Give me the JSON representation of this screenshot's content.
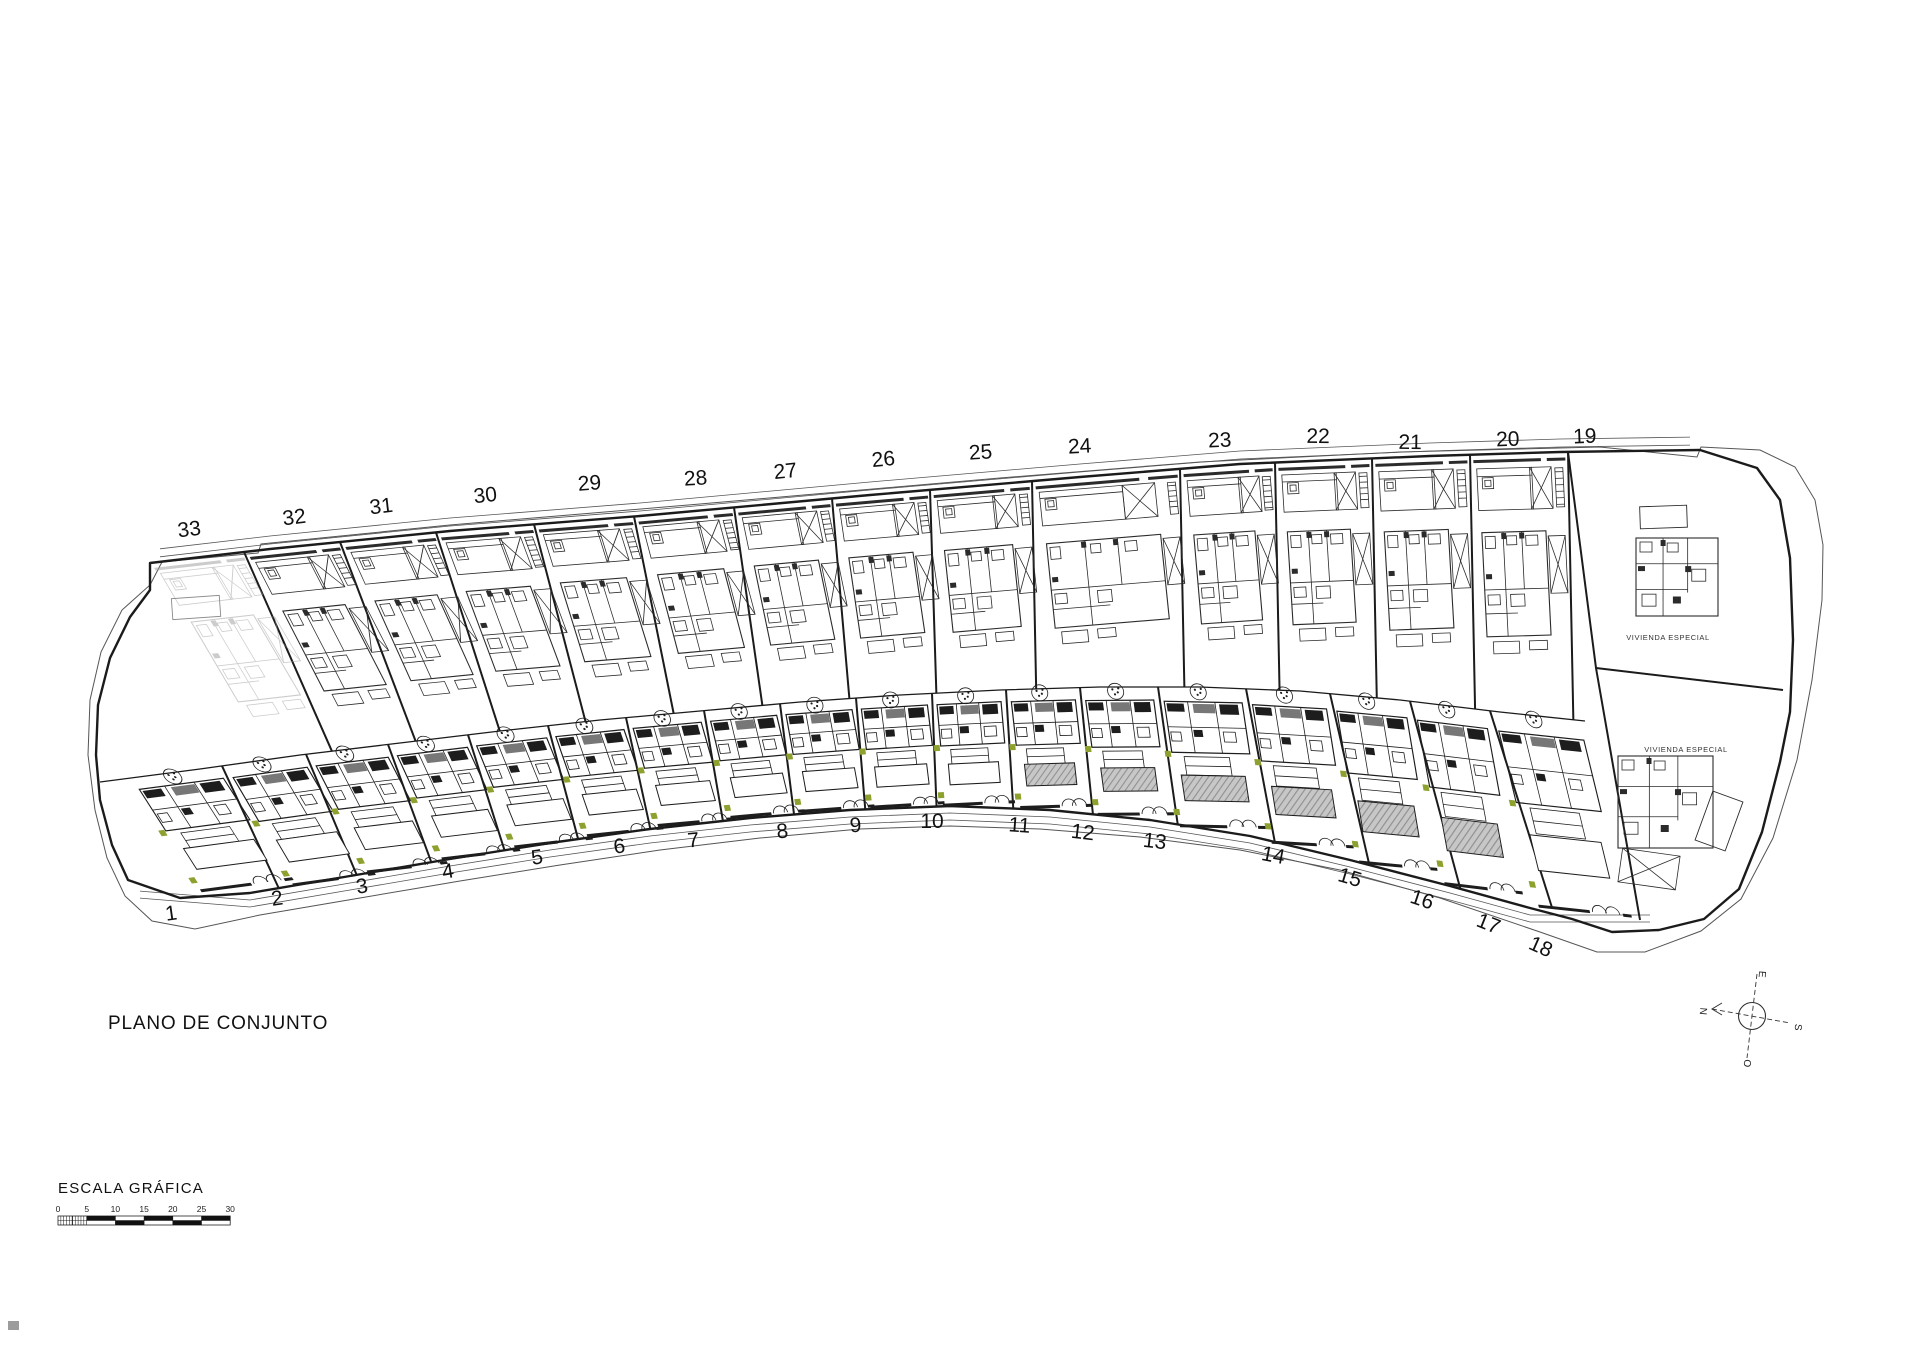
{
  "page": {
    "title": "PLANO DE CONJUNTO"
  },
  "scale_bar": {
    "title": "ESCALA GRÁFICA",
    "ticks": [
      "0",
      "5",
      "10",
      "15",
      "20",
      "25",
      "30"
    ]
  },
  "compass": {
    "north": "N",
    "south": "S",
    "east": "E",
    "west": "O"
  },
  "special_plots": [
    {
      "label": "VIVIENDA ESPECIAL",
      "x": 1668,
      "y": 640
    },
    {
      "label": "VIVIENDA ESPECIAL",
      "x": 1686,
      "y": 752
    }
  ],
  "plots": {
    "top_row": [
      {
        "number": "33",
        "label_x": 190,
        "label_y": 536
      },
      {
        "number": "32",
        "label_x": 295,
        "label_y": 524
      },
      {
        "number": "31",
        "label_x": 382,
        "label_y": 513
      },
      {
        "number": "30",
        "label_x": 486,
        "label_y": 502
      },
      {
        "number": "29",
        "label_x": 590,
        "label_y": 490
      },
      {
        "number": "28",
        "label_x": 696,
        "label_y": 485
      },
      {
        "number": "27",
        "label_x": 786,
        "label_y": 478
      },
      {
        "number": "26",
        "label_x": 884,
        "label_y": 466
      },
      {
        "number": "25",
        "label_x": 981,
        "label_y": 459
      },
      {
        "number": "24",
        "label_x": 1080,
        "label_y": 453
      },
      {
        "number": "23",
        "label_x": 1220,
        "label_y": 447
      },
      {
        "number": "22",
        "label_x": 1318,
        "label_y": 443
      },
      {
        "number": "21",
        "label_x": 1410,
        "label_y": 449
      },
      {
        "number": "20",
        "label_x": 1508,
        "label_y": 446
      },
      {
        "number": "19",
        "label_x": 1585,
        "label_y": 443
      }
    ],
    "bottom_row": [
      {
        "number": "1",
        "label_x": 172,
        "label_y": 920
      },
      {
        "number": "2",
        "label_x": 278,
        "label_y": 905
      },
      {
        "number": "3",
        "label_x": 363,
        "label_y": 893
      },
      {
        "number": "4",
        "label_x": 449,
        "label_y": 878
      },
      {
        "number": "5",
        "label_x": 538,
        "label_y": 864
      },
      {
        "number": "6",
        "label_x": 620,
        "label_y": 853
      },
      {
        "number": "7",
        "label_x": 694,
        "label_y": 847
      },
      {
        "number": "8",
        "label_x": 783,
        "label_y": 838
      },
      {
        "number": "9",
        "label_x": 856,
        "label_y": 832
      },
      {
        "number": "10",
        "label_x": 932,
        "label_y": 828
      },
      {
        "number": "11",
        "label_x": 1019,
        "label_y": 832
      },
      {
        "number": "12",
        "label_x": 1082,
        "label_y": 839
      },
      {
        "number": "13",
        "label_x": 1154,
        "label_y": 848
      },
      {
        "number": "14",
        "label_x": 1272,
        "label_y": 862
      },
      {
        "number": "15",
        "label_x": 1348,
        "label_y": 884
      },
      {
        "number": "16",
        "label_x": 1420,
        "label_y": 906
      },
      {
        "number": "17",
        "label_x": 1486,
        "label_y": 930
      },
      {
        "number": "18",
        "label_x": 1538,
        "label_y": 953
      }
    ]
  },
  "colors": {
    "line": "#1b1b1b",
    "thin": "#555555",
    "pool_gray": "#c7c7c7",
    "pool_hatch": "#8f8f8f",
    "marker_green": "#8ca12e",
    "faded": "#9a9a9a"
  }
}
